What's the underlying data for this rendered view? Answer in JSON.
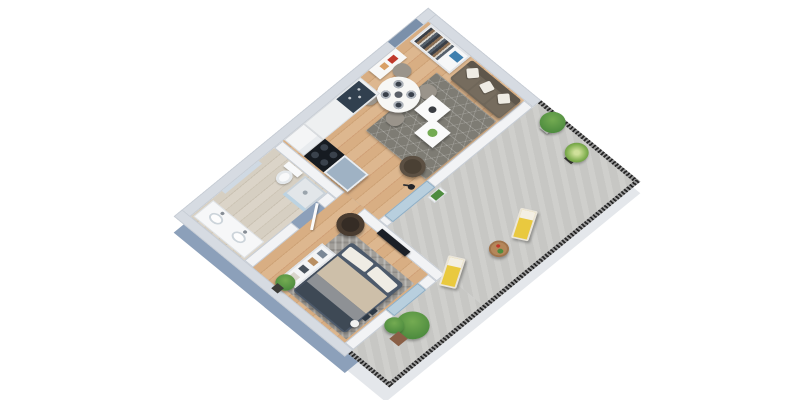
{
  "scene": {
    "kind": "isometric-3d-floor-plan-render",
    "background": "#ffffff",
    "projection": "rotated-45deg-birdseye"
  },
  "rooms": [
    {
      "name": "living-dining-room",
      "floor": "light-oak-wood"
    },
    {
      "name": "kitchen",
      "floor": "light-oak-wood"
    },
    {
      "name": "entry-hall",
      "floor": "light-oak-wood"
    },
    {
      "name": "bedroom",
      "floor": "wood-with-gray-stone-rug"
    },
    {
      "name": "bathroom",
      "floor": "light-beige-wood"
    },
    {
      "name": "terrace",
      "floor": "gray-concrete",
      "enclosure": "black-mesh-railing"
    }
  ],
  "furniture": {
    "entry": [
      "open-closet-with-clothes",
      "blue-storage-box",
      "entry-door",
      "white-console-with-red-decor"
    ],
    "living": [
      "round-dining-table",
      "four-gray-chairs",
      "dark-plates",
      "gray-brown-sofa",
      "three-white-pillows",
      "hexagon-pattern-gray-rug",
      "two-white-coffee-tables",
      "dark-curved-armchair",
      "black-floor-lamp",
      "wall-mounted-tv"
    ],
    "kitchen": [
      "counter-with-navy-sink",
      "black-cooktop",
      "blue-gray-island",
      "white-tall-cabinet"
    ],
    "bedroom": [
      "double-bed-gray-beige-bedding",
      "dark-papasan-chair",
      "open-shelf-unit",
      "ball-lamp",
      "potted-plant"
    ],
    "bathroom": [
      "toilet",
      "walk-in-glass-shower",
      "double-basin-vanity",
      "wall-mirror"
    ],
    "terrace": [
      "fiddle-leaf-plant-white-pot",
      "grass-plant-dark-pot",
      "small-wall-planter",
      "yellow-lounger-north",
      "yellow-lounger-south",
      "round-wood-side-table",
      "large-potted-plant"
    ]
  },
  "palette": {
    "wall-ext-face": "#8ca0ba",
    "slab-terrace": "#e4e7eb",
    "wall-top-ext": "#d6dbe2",
    "wall-top-int": "#f2f3f5",
    "wall-edge": "#c6ccd4",
    "wood-1": "#d8ae83",
    "wood-2": "#cda276",
    "wood-3": "#ddb78f",
    "wood-4": "#d0a077",
    "bath-1": "#d6cfc2",
    "bath-2": "#c9c1b2",
    "bath-3": "#dbd4c8",
    "bath-4": "#cdc5b6",
    "terrace-floor": "#c7c7c4",
    "rug-living": "#7e7c74",
    "rug-bedroom": "#a19e99",
    "railing-dark": "#262626",
    "railing-light": "#9a9a9a",
    "glass": "#bcd3e2",
    "sofa-base": "#6f6659",
    "sofa-back": "#5e564b",
    "pillow": "#efece4",
    "table-white": "#f7f7f5",
    "chair-gray": "#9a948b",
    "plate-dark": "#39404a",
    "console-red": "#c0392b",
    "counter-white": "#eef0f1",
    "sink-navy": "#31404f",
    "stove-black": "#161b21",
    "island-blue": "#9fb2c4",
    "fridge-white": "#f4f5f6",
    "coffee-table": "#fafafa",
    "armchair-dark": "#4a4034",
    "lamp-black": "#23252a",
    "bed-frame": "#4d5a6b",
    "bed-beige": "#cdbfa9",
    "bed-gray": "#8e9195",
    "bed-foot": "#3e4955",
    "papasan": "#352c25",
    "shelf-white": "#f3f4f5",
    "toilet-white": "#f8f9fa",
    "shower-tray": "#e2e6e9",
    "vanity-white": "#f6f7f8",
    "mirror-blue": "#cfd9e3",
    "lounger-yellow": "#e9c93f",
    "lounger-frame": "#eae5da",
    "wood-table": "#b5875a",
    "plant-green": "#4e8c3f",
    "plant-light": "#74ab52",
    "pot-dark": "#3c3c38",
    "pot-white": "#ececea",
    "pot-terra": "#8a5f46",
    "door-recess": "#7b90aa",
    "tv-black": "#1b1f26",
    "blue-box": "#3f7fae"
  }
}
